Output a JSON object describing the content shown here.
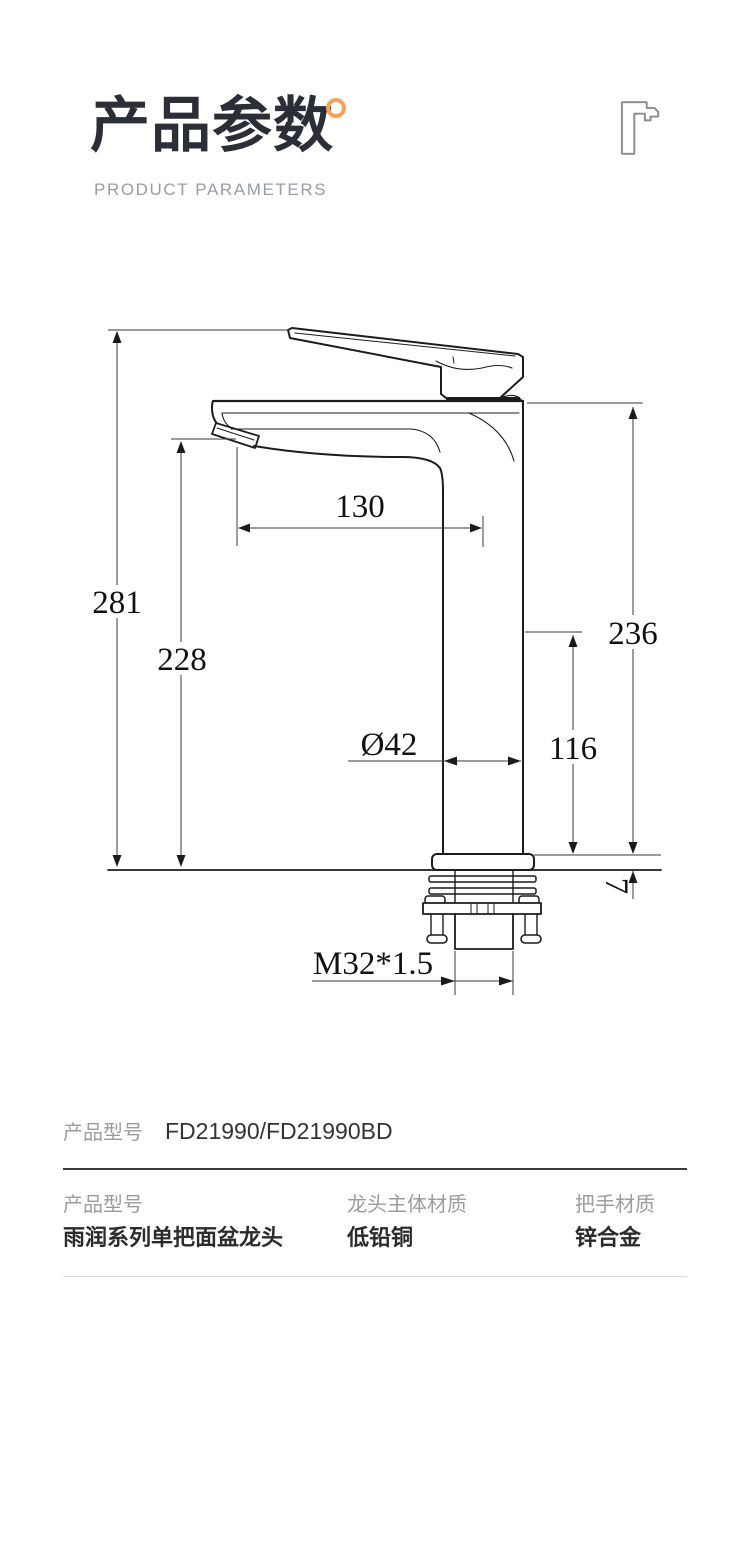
{
  "header": {
    "title": "产品参数",
    "subtitle": "PRODUCT PARAMETERS",
    "accent_color": "#F3A35D"
  },
  "drawing": {
    "dims": {
      "h281": "281",
      "h228": "228",
      "w130": "130",
      "h236": "236",
      "h116": "116",
      "d42": "Ø42",
      "t7": "7",
      "thread": "M32*1.5"
    }
  },
  "model_row": {
    "label": "产品型号",
    "value": "FD21990/FD21990BD"
  },
  "spec_table": {
    "columns": [
      {
        "label": "产品型号",
        "value": "雨润系列单把面盆龙头"
      },
      {
        "label": "龙头主体材质",
        "value": "低铅铜"
      },
      {
        "label": "把手材质",
        "value": "锌合金"
      }
    ]
  }
}
